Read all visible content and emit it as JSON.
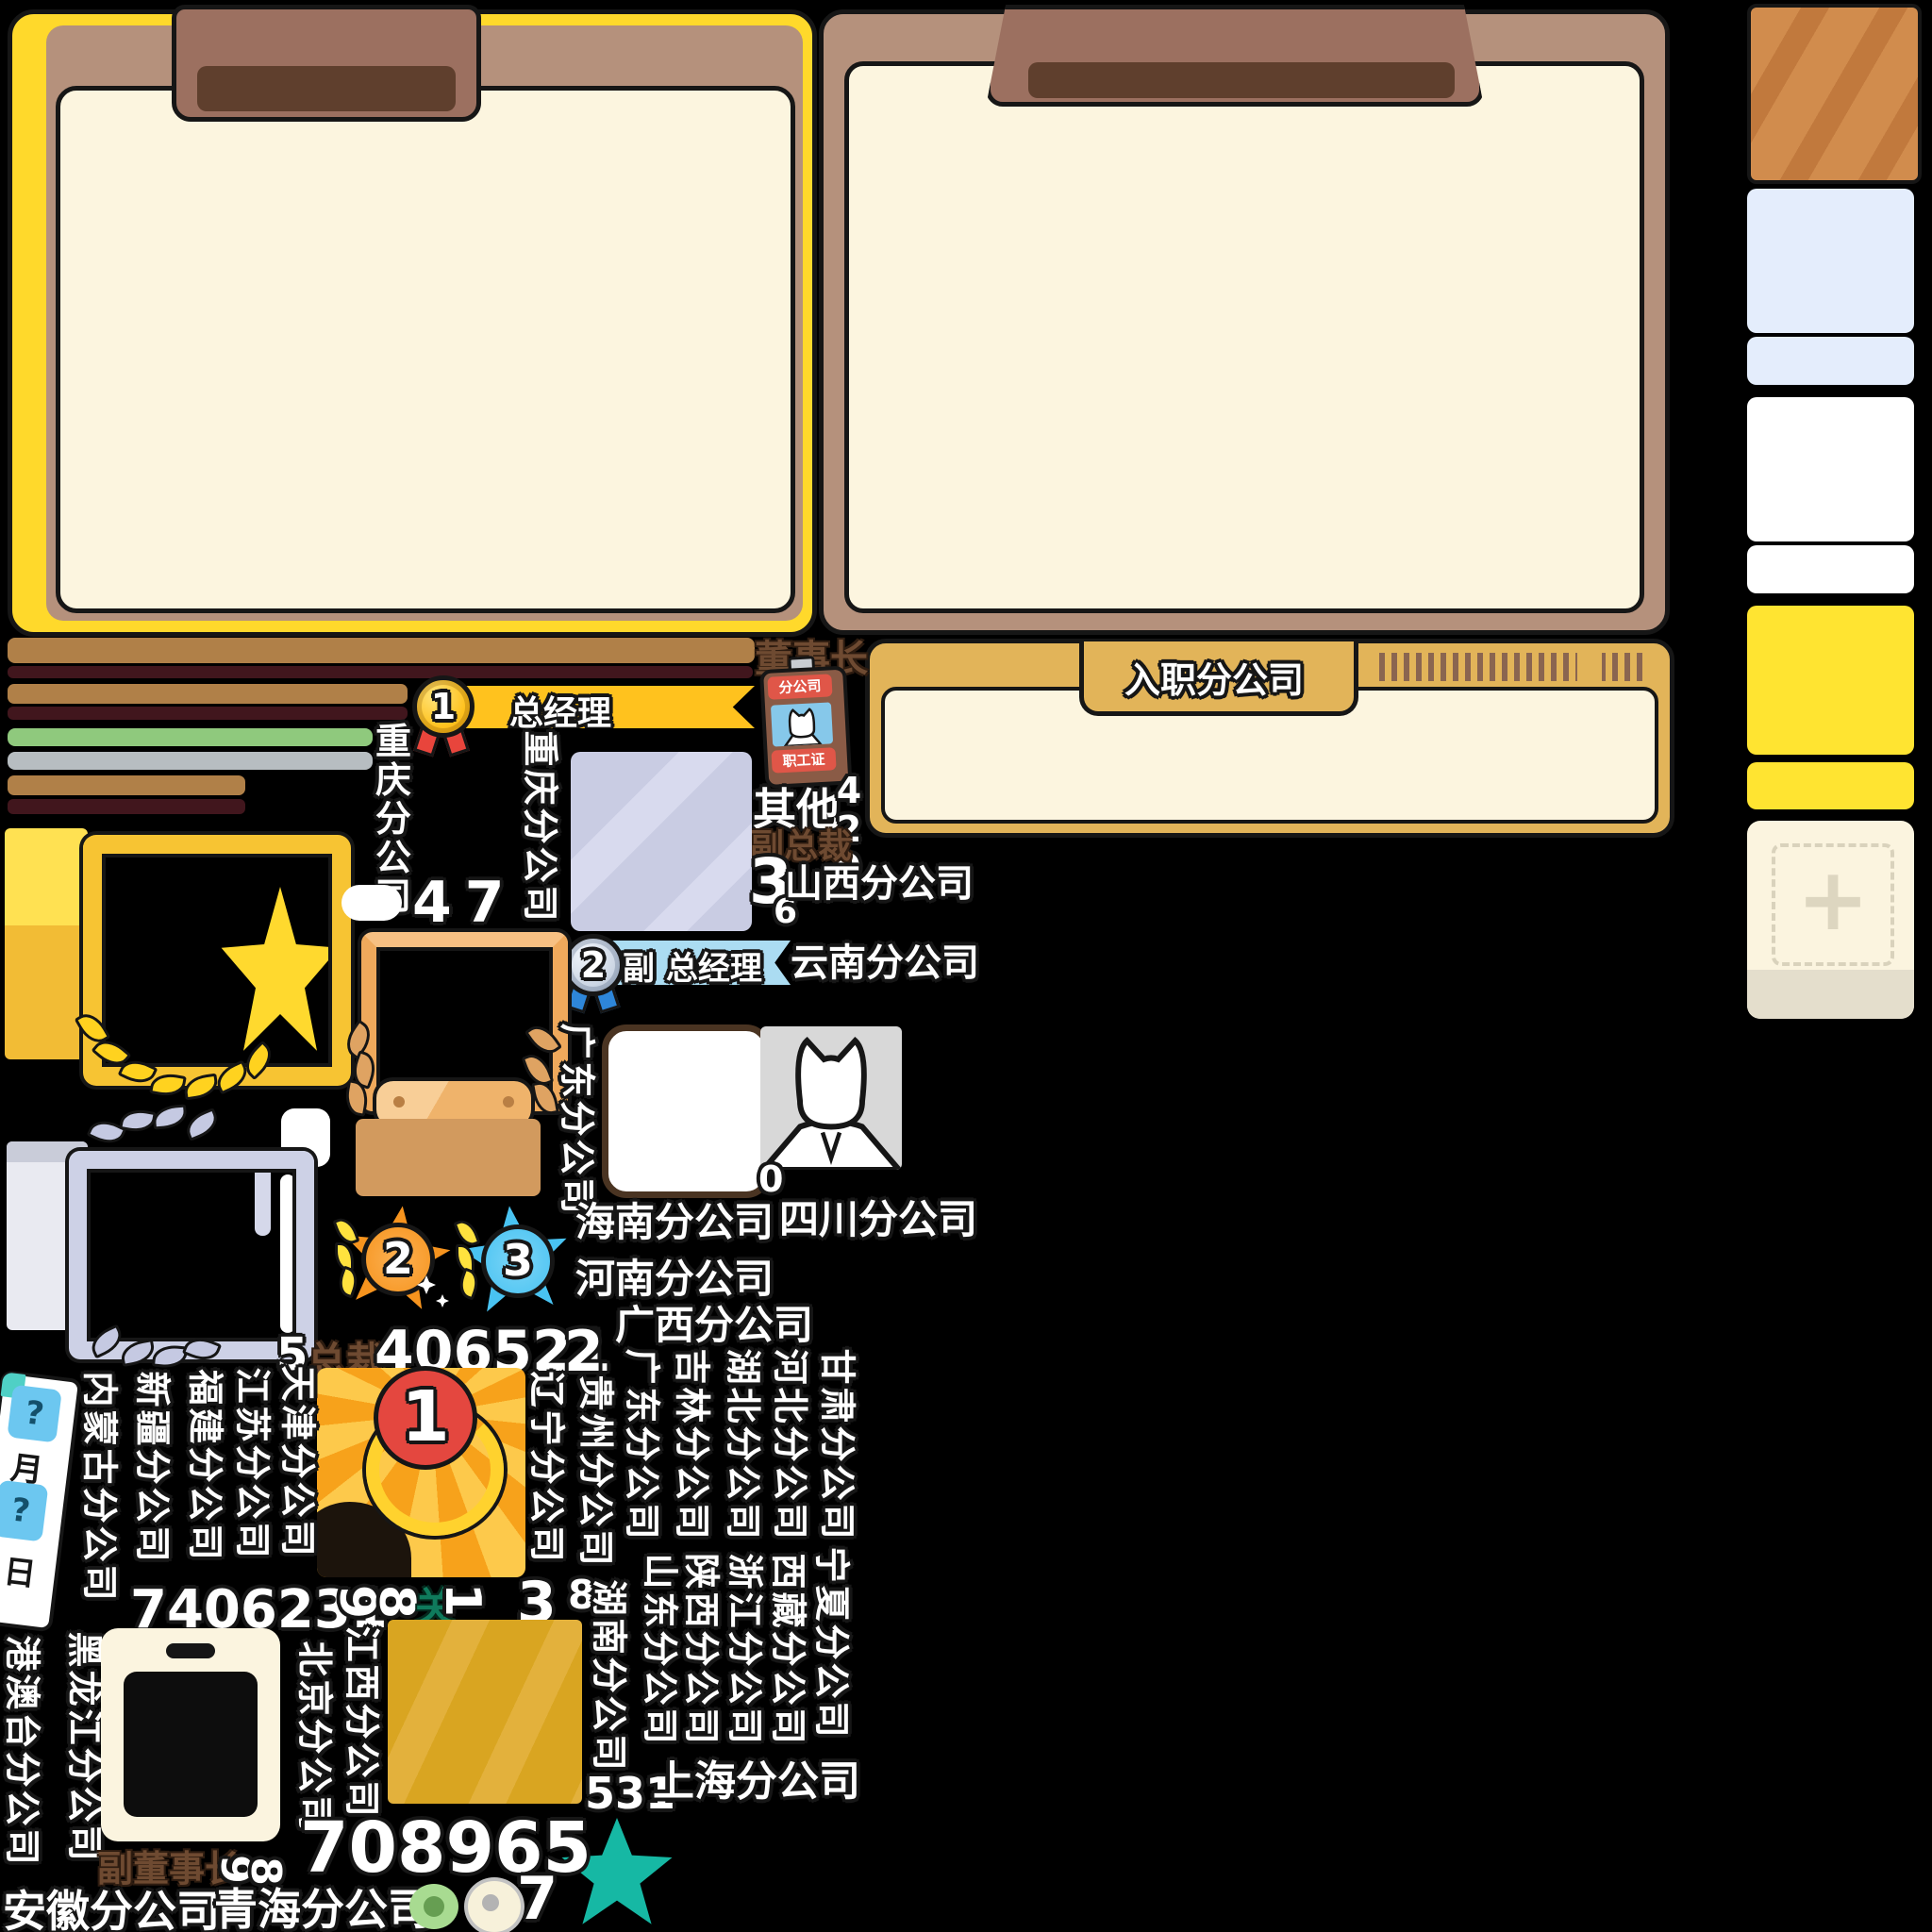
{
  "employ_panel": {
    "title": "入职分公司"
  },
  "ranks": {
    "chairman": "董事长",
    "general_manager": "总经理",
    "deputy_general_manager": "副 总经理",
    "president": "总裁",
    "vice_president": "副总裁",
    "vice_chairman": "副董事长"
  },
  "employee_badge": {
    "top": "分公司",
    "bottom": "职工证"
  },
  "labels": {
    "other": "其他",
    "guan": "关"
  },
  "medals": {
    "m1": "1",
    "m2": "2",
    "star2": "2",
    "star3": "3",
    "big1": "1"
  },
  "date": {
    "q1": "?",
    "month": "月",
    "q2": "?",
    "day": "日"
  },
  "numbers": {
    "n429": "429",
    "n3": "3",
    "n6": "6",
    "n47": "47",
    "n0": "0",
    "n5": "5",
    "n406521": "406521",
    "n2": "2",
    "n7406231": "7406231",
    "n9r": "9",
    "n8r": "8",
    "n1r": "1",
    "n3big": "3",
    "n8s": "8",
    "n531": "531",
    "n708965": "708965",
    "n9b": "9",
    "n8b": "8",
    "n7": "7"
  },
  "companies": {
    "chongqing": "重庆分公司",
    "shanxi": "山西分公司",
    "yunnan": "云南分公司",
    "guangdong": "广东分公司",
    "hainan": "海南分公司",
    "sichuan": "四川分公司",
    "henan": "河南分公司",
    "guangxi": "广西分公司",
    "gansu": "甘肃分公司",
    "hebei": "河北分公司",
    "hubei": "湖北分公司",
    "jilin": "吉林分公司",
    "guizhou": "贵州分公司",
    "liaoning": "辽宁分公司",
    "hunan": "湖南分公司",
    "shandong": "山东分公司",
    "shaanxi": "陕西分公司",
    "zhejiang": "浙江分公司",
    "xizang": "西藏分公司",
    "ningxia": "宁夏分公司",
    "shanghai": "上海分公司",
    "tianjin": "天津分公司",
    "jiangsu": "江苏分公司",
    "fujian": "福建分公司",
    "xinjiang": "新疆分公司",
    "neimenggu": "内蒙古分公司",
    "gangaotai": "港澳台分公司",
    "heilongjiang": "黑龙江分公司",
    "beijing": "北京分公司",
    "jiangxi": "江西分公司",
    "anhui": "安徽分公司",
    "qinghai": "青海分公司"
  },
  "colors": {
    "panel_cream": "#FCF5DF",
    "panel_tan": "#B5917C",
    "panel_yellow": "#FFD92B",
    "tab_brown": "#9C7060",
    "tab_dark": "#61402D",
    "employ_gold": "#E2B459",
    "bar_tan": "#B08048",
    "bar_maroon": "#41161D",
    "bar_green": "#8FC97D",
    "bar_gray": "#B7BDC1",
    "ribbon_gold": "#FFC21E",
    "ribbon_blue": "#ABDCF2",
    "star_orange": "#F7941E",
    "star_blue": "#49C3F2",
    "star_teal": "#16B8A4",
    "lavender": "#C9CCE3",
    "gold_square": "#D9A521",
    "wood": "#D18C4D",
    "badge_red": "#E4473F",
    "rect_yellow": "#FFE431",
    "rect_blue": "#E4EDFC"
  }
}
